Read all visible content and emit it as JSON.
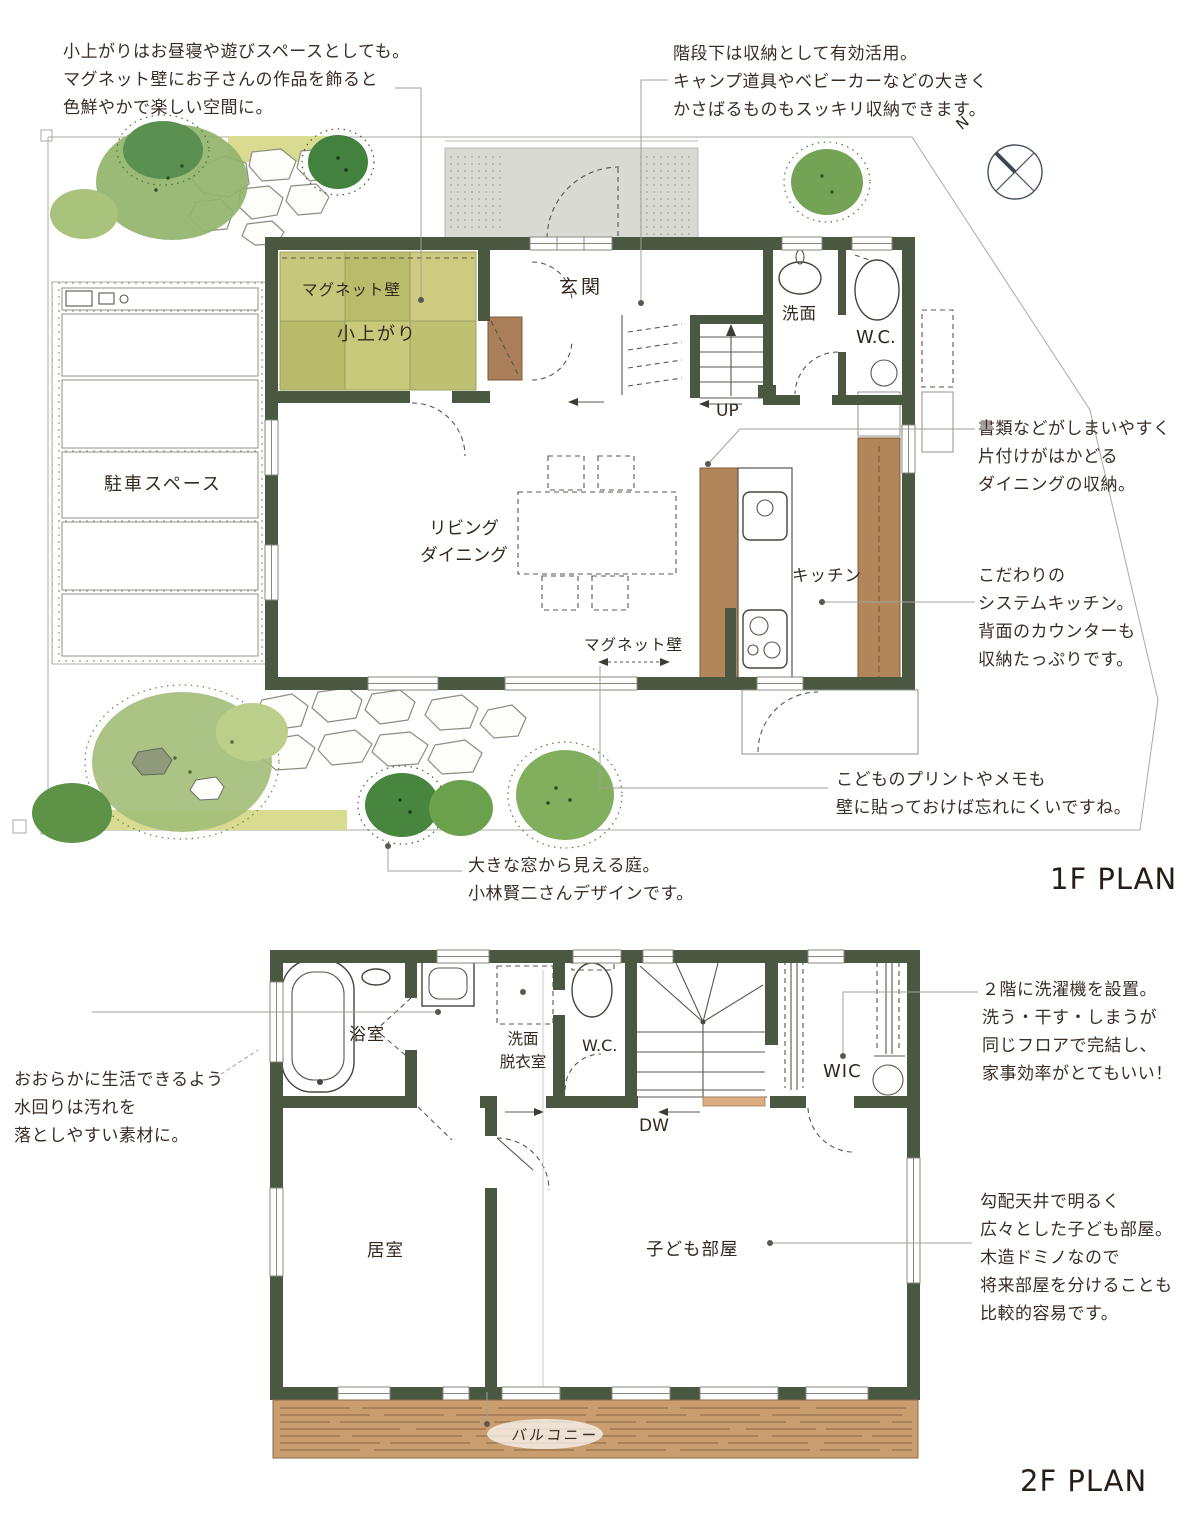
{
  "colors": {
    "wall": "#4a5741",
    "tatami": "#c6c77a",
    "wood_counter": "#b2865a",
    "balcony_wood": "#c99d6e",
    "tree_green": "#81af5e",
    "text": "#3a2d25"
  },
  "compass": {
    "north": "N"
  },
  "floor1": {
    "plan_title": "1F PLAN",
    "rooms": {
      "magnet_wall": "マグネット壁",
      "koagari": "小上がり",
      "genkan": "玄関",
      "senmen": "洗面",
      "wc": "W.C.",
      "up": "UP",
      "parking": "駐車スペース",
      "living1": "リビング",
      "living2": "ダイニング",
      "kitchen": "キッチン",
      "magnet_wall_arrow": "マグネット壁"
    },
    "notes": {
      "koagari": [
        "小上がりはお昼寝や遊びスペースとしても。",
        "マグネット壁にお子さんの作品を飾ると",
        "色鮮やかで楽しい空間に。"
      ],
      "stairs": [
        "階段下は収納として有効活用。",
        "キャンプ道具やベビーカーなどの大きく",
        "かさばるものもスッキリ収納できます。"
      ],
      "dining_storage": [
        "書類などがしまいやすく",
        "片付けがはかどる",
        "ダイニングの収納。"
      ],
      "kitchen": [
        "こだわりの",
        "システムキッチン。",
        "背面のカウンターも",
        "収納たっぷりです。"
      ],
      "magnet": [
        "こどものプリントやメモも",
        "壁に貼っておけば忘れにくいですね。"
      ],
      "garden": [
        "大きな窓から見える庭。",
        "小林賢二さんデザインです。"
      ]
    }
  },
  "floor2": {
    "plan_title": "2F PLAN",
    "rooms": {
      "bathroom": "浴室",
      "senmen1": "洗面",
      "senmen2": "脱衣室",
      "wc": "W.C.",
      "dw": "DW",
      "wic": "WIC",
      "bedroom": "居室",
      "kids_room": "子ども部屋",
      "balcony": "バルコニー"
    },
    "notes": {
      "water": [
        "おおらかに生活できるよう",
        "水回りは汚れを",
        "落としやすい素材に。"
      ],
      "laundry": [
        "２階に洗濯機を設置。",
        "洗う・干す・しまうが",
        "同じフロアで完結し、",
        "家事効率がとてもいい！"
      ],
      "kids": [
        "勾配天井で明るく",
        "広々とした子ども部屋。",
        "木造ドミノなので",
        "将来部屋を分けることも",
        "比較的容易です。"
      ]
    }
  }
}
